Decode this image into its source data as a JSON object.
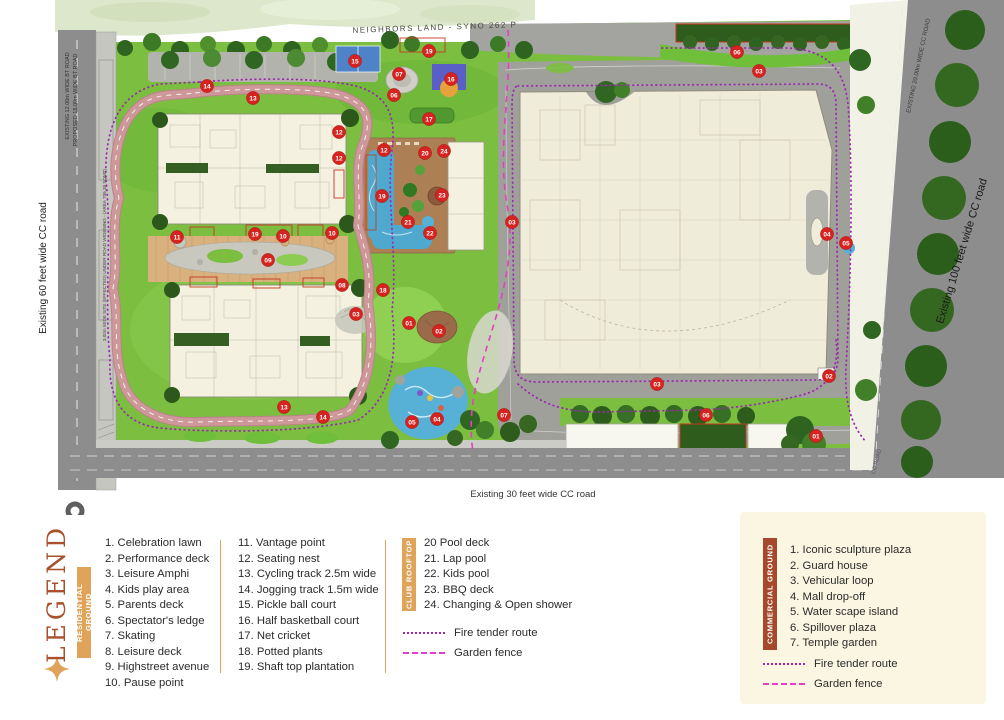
{
  "colors": {
    "terracotta": "#A8512C",
    "gold": "#DFA35A",
    "brick": "#A6482C",
    "cream": "#FBF6E2",
    "fire": "#9C27B0",
    "fence": "#E23FC4",
    "marker": "#D6231F"
  },
  "map": {
    "neighbors_label": "NEIGHBORS LAND - SYNO 262 P",
    "labels": {
      "left_road": "Existing 60 feet wide CC road",
      "right_road": "Existing 100 feet wide CC road",
      "bottom_road": "Existing 30 feet wide CC road",
      "top_left_road_1": "EXISTING 12.00m WIDE BT ROAD",
      "top_left_road_2": "PROPOSED 18.00m WIDE BT ROAD",
      "left_strip": "3.00m WIDE SITE (EFFECTED) UNDER ROAD WIDENING - (AREA 706.38 SQMT)",
      "top_right_road": "EXISTING 20.00m WIDE CC ROAD",
      "bottom_right_road": "CC ROAD"
    },
    "markers": [
      {
        "n": "14",
        "x": 207,
        "y": 86
      },
      {
        "n": "13",
        "x": 253,
        "y": 98
      },
      {
        "n": "15",
        "x": 355,
        "y": 61
      },
      {
        "n": "19",
        "x": 429,
        "y": 51
      },
      {
        "n": "07",
        "x": 399,
        "y": 74
      },
      {
        "n": "16",
        "x": 451,
        "y": 79
      },
      {
        "n": "06",
        "x": 394,
        "y": 95
      },
      {
        "n": "17",
        "x": 429,
        "y": 119
      },
      {
        "n": "12",
        "x": 339,
        "y": 132
      },
      {
        "n": "12",
        "x": 339,
        "y": 158
      },
      {
        "n": "12",
        "x": 384,
        "y": 150
      },
      {
        "n": "20",
        "x": 425,
        "y": 153
      },
      {
        "n": "24",
        "x": 444,
        "y": 151
      },
      {
        "n": "19",
        "x": 382,
        "y": 196
      },
      {
        "n": "23",
        "x": 442,
        "y": 195
      },
      {
        "n": "21",
        "x": 408,
        "y": 222
      },
      {
        "n": "22",
        "x": 430,
        "y": 233
      },
      {
        "n": "11",
        "x": 177,
        "y": 237
      },
      {
        "n": "19",
        "x": 255,
        "y": 234
      },
      {
        "n": "10",
        "x": 283,
        "y": 236
      },
      {
        "n": "10",
        "x": 332,
        "y": 233
      },
      {
        "n": "09",
        "x": 268,
        "y": 260
      },
      {
        "n": "08",
        "x": 342,
        "y": 285
      },
      {
        "n": "18",
        "x": 383,
        "y": 290
      },
      {
        "n": "03",
        "x": 356,
        "y": 314
      },
      {
        "n": "01",
        "x": 409,
        "y": 323
      },
      {
        "n": "02",
        "x": 439,
        "y": 331
      },
      {
        "n": "13",
        "x": 284,
        "y": 407
      },
      {
        "n": "14",
        "x": 323,
        "y": 417
      },
      {
        "n": "05",
        "x": 412,
        "y": 422
      },
      {
        "n": "04",
        "x": 437,
        "y": 419
      },
      {
        "n": "07",
        "x": 504,
        "y": 415
      },
      {
        "n": "06",
        "x": 737,
        "y": 52
      },
      {
        "n": "03",
        "x": 759,
        "y": 71
      },
      {
        "n": "03",
        "x": 512,
        "y": 222
      },
      {
        "n": "04",
        "x": 827,
        "y": 234
      },
      {
        "n": "05",
        "x": 846,
        "y": 243
      },
      {
        "n": "02",
        "x": 829,
        "y": 376
      },
      {
        "n": "03",
        "x": 657,
        "y": 384
      },
      {
        "n": "06",
        "x": 706,
        "y": 415
      },
      {
        "n": "01",
        "x": 816,
        "y": 436
      }
    ]
  },
  "legend": {
    "title": "LEGEND",
    "residential": {
      "badge": "RESIDENTIAL GROUND",
      "col1": [
        "1. Celebration lawn",
        "2. Performance deck",
        "3. Leisure Amphi",
        "4. Kids play area",
        "5. Parents deck",
        "6. Spectator's ledge",
        "7. Skating",
        "8. Leisure deck",
        "9. Highstreet avenue",
        "10. Pause point"
      ],
      "col2": [
        "11. Vantage point",
        "12. Seating nest",
        "13. Cycling track 2.5m wide",
        "14. Jogging track 1.5m wide",
        "15. Pickle ball court",
        "16. Half basketball court",
        "17. Net cricket",
        "18. Potted plants",
        "19. Shaft top plantation"
      ]
    },
    "club": {
      "badge": "CLUB ROOFTOP",
      "items": [
        "20 Pool deck",
        "21. Lap pool",
        "22. Kids pool",
        "23. BBQ deck",
        "24. Changing & Open shower"
      ]
    },
    "routes": {
      "fire_label": "Fire tender route",
      "fence_label": "Garden fence"
    },
    "commercial": {
      "badge": "COMMERCIAL GROUND",
      "items": [
        "1. Iconic sculpture plaza",
        "2. Guard house",
        "3. Vehicular loop",
        "4. Mall drop-off",
        "5. Water scape island",
        "6. Spillover plaza",
        "7. Temple garden"
      ],
      "fire_label": "Fire tender route",
      "fence_label": "Garden fence"
    }
  }
}
